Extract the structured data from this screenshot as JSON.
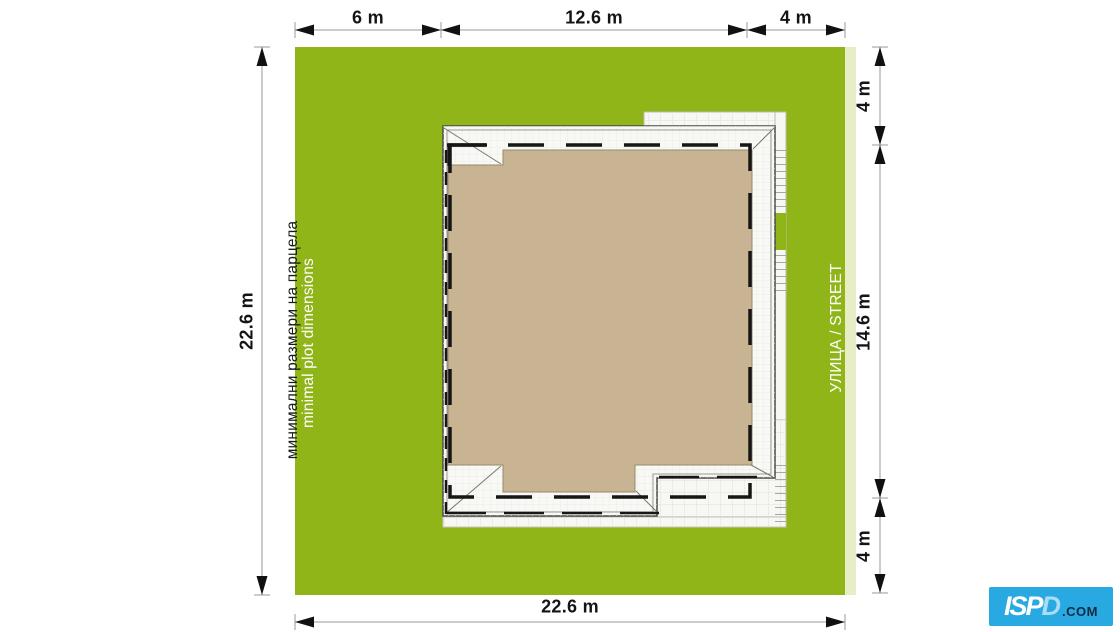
{
  "palette": {
    "plot_green": "#90b518",
    "sidewalk_pale": "#e9edc6",
    "roof_tan": "#c8b392",
    "paved_white": "#f7f7f3",
    "logo_blue": "#29a9e1"
  },
  "dims": {
    "top": [
      "6 m",
      "12.6 m",
      "4 m"
    ],
    "left": "22.6 m",
    "right": [
      "4 m",
      "14.6 m",
      "4 m"
    ],
    "bottom": "22.6 m"
  },
  "labels": {
    "plot_bg": "минимални размери на парцела",
    "plot_en": "minimal plot dimensions",
    "street": "УЛИЦА / STREET"
  },
  "logo": {
    "main": "ISP",
    "d": "D",
    "suffix": ".COM"
  }
}
